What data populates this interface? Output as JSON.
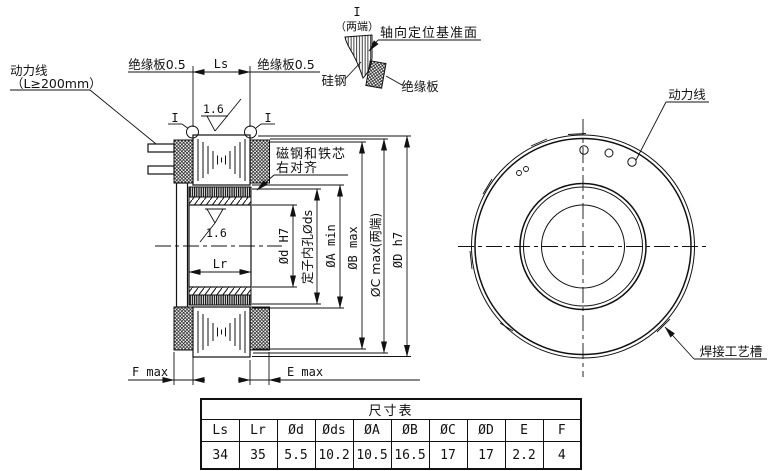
{
  "section_view": {
    "power_line_label": "动力线",
    "power_line_note": "（L≥200mm）",
    "insulation_left": "绝缘板0.5",
    "insulation_right": "绝缘板0.5",
    "dim_ls": "Ls",
    "dim_lr": "Lr",
    "detail_mark_left": "I",
    "detail_mark_right": "I",
    "roughness_top": "1.6",
    "roughness_bore": "1.6",
    "magnet_align_note_line1": "磁钢和铁芯",
    "magnet_align_note_line2": "右对齐",
    "dim_f": "F max",
    "dim_e": "E max",
    "dim_d_bore": "Ød H7",
    "dim_ds": "定子内孔Øds",
    "dim_a": "ØA min",
    "dim_b": "ØB max",
    "dim_c": "ØC max(两端)",
    "dim_dd": "ØD h7"
  },
  "detail_view": {
    "mark": "I",
    "mark_note": "（两端）",
    "datum_label": "轴向定位基准面",
    "silicon_steel_label": "硅钢",
    "insulation_label": "绝缘板"
  },
  "front_view": {
    "power_line_label": "动力线",
    "weld_groove_label": "焊接工艺槽"
  },
  "size_table": {
    "title": "尺寸表",
    "headers": [
      "Ls",
      "Lr",
      "Ød",
      "Øds",
      "ØA",
      "ØB",
      "ØC",
      "ØD",
      "E",
      "F"
    ],
    "values": [
      "34",
      "35",
      "5.5",
      "10.2",
      "10.5",
      "16.5",
      "17",
      "17",
      "2.2",
      "4"
    ]
  }
}
